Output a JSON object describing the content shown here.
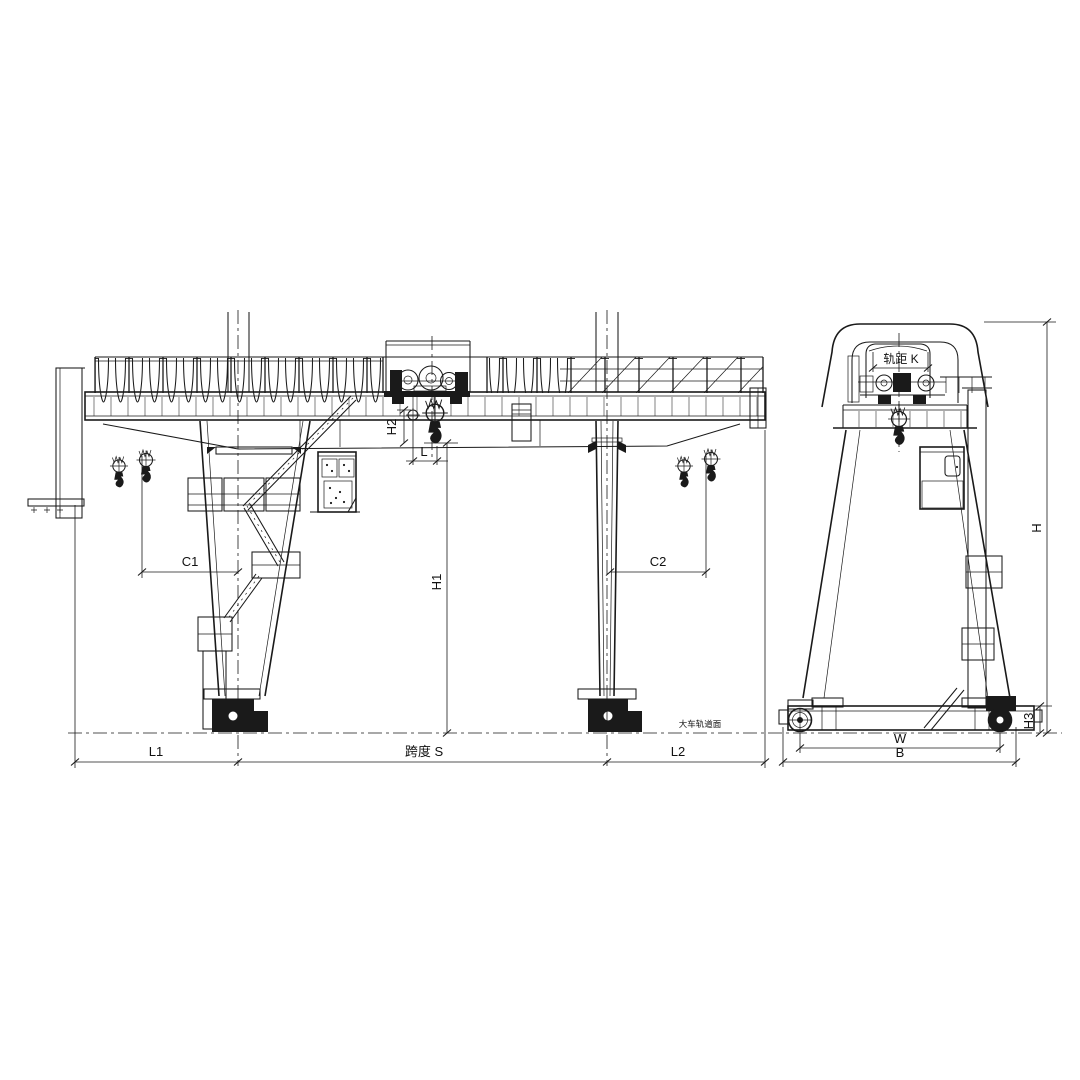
{
  "colors": {
    "line": "#1a1a1a",
    "background": "#ffffff"
  },
  "front_view": {
    "dim_l1": "L1",
    "dim_span": "跨度 S",
    "dim_l2": "L2",
    "dim_c1": "C1",
    "dim_c2": "C2",
    "dim_h1": "H1",
    "dim_h2": "H2",
    "dim_l": "L",
    "rail_note": "大车轨道面"
  },
  "side_view": {
    "dim_k": "轨距 K",
    "dim_h": "H",
    "dim_h3": "H3",
    "dim_w": "W",
    "dim_b": "B"
  }
}
